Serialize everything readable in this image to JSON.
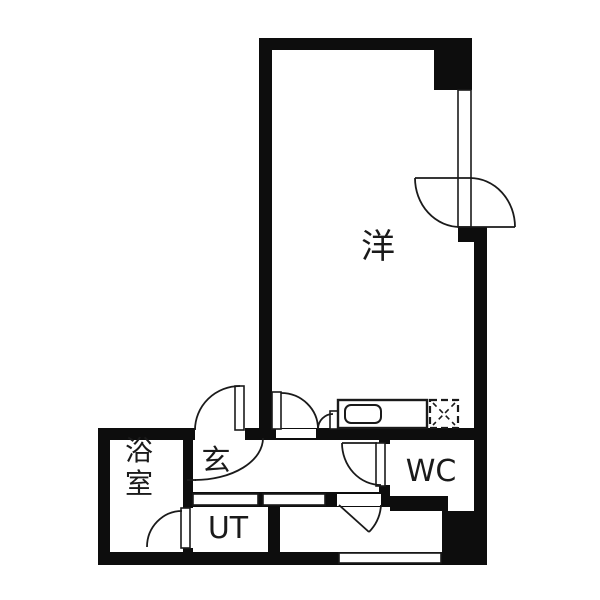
{
  "meta": {
    "type": "japanese-apartment-floorplan",
    "canvas_width": 600,
    "canvas_height": 600,
    "background_color": "#ffffff",
    "wall_color": "#0d0d0d",
    "line_color": "#1a1a1a"
  },
  "rooms": [
    {
      "id": "western-room",
      "label": "洋",
      "x": 378,
      "y": 258,
      "font": 34,
      "vertical": false
    },
    {
      "id": "entrance",
      "label": "玄",
      "x": 216,
      "y": 470,
      "font": 29,
      "vertical": false
    },
    {
      "id": "bathroom",
      "label": "浴室",
      "x": 139,
      "y": 460,
      "font": 28,
      "vertical": true
    },
    {
      "id": "utility",
      "label": "UT",
      "x": 228,
      "y": 538,
      "font": 30,
      "vertical": false
    },
    {
      "id": "toilet",
      "label": "WC",
      "x": 431,
      "y": 481,
      "font": 30,
      "vertical": false
    }
  ],
  "walls": [
    {
      "name": "top-wall",
      "x": 259,
      "y": 38,
      "w": 213,
      "h": 12
    },
    {
      "name": "left-wall-main-room",
      "x": 259,
      "y": 38,
      "w": 13,
      "h": 402
    },
    {
      "name": "top-right-block",
      "x": 434,
      "y": 38,
      "w": 38,
      "h": 52
    },
    {
      "name": "right-step-block",
      "x": 458,
      "y": 227,
      "w": 29,
      "h": 15
    },
    {
      "name": "right-wall",
      "x": 474,
      "y": 242,
      "w": 13,
      "h": 196
    },
    {
      "name": "kitchen-corridor-band",
      "x": 245,
      "y": 428,
      "w": 242,
      "h": 12
    },
    {
      "name": "entry-top-band",
      "x": 98,
      "y": 428,
      "w": 97,
      "h": 12
    },
    {
      "name": "left-outer-wall",
      "x": 98,
      "y": 428,
      "w": 12,
      "h": 137
    },
    {
      "name": "bottom-wall",
      "x": 98,
      "y": 552,
      "w": 345,
      "h": 13
    },
    {
      "name": "bath-right-wall",
      "x": 183,
      "y": 438,
      "w": 10,
      "h": 70
    },
    {
      "name": "bath-right-wall-low",
      "x": 183,
      "y": 548,
      "w": 10,
      "h": 8
    },
    {
      "name": "corridor-bottom-band",
      "x": 192,
      "y": 492,
      "w": 198,
      "h": 15
    },
    {
      "name": "wc-hinge-wall-top",
      "x": 379,
      "y": 430,
      "w": 11,
      "h": 14
    },
    {
      "name": "wc-hinge-wall-bottom",
      "x": 379,
      "y": 485,
      "w": 11,
      "h": 11
    },
    {
      "name": "wc-right-wall",
      "x": 474,
      "y": 438,
      "w": 13,
      "h": 73
    },
    {
      "name": "ut-right-wall",
      "x": 268,
      "y": 507,
      "w": 12,
      "h": 45
    },
    {
      "name": "bottom-right-block",
      "x": 442,
      "y": 511,
      "w": 45,
      "h": 54
    }
  ],
  "white_areas": [
    {
      "name": "wc-interior",
      "x": 390,
      "y": 440,
      "w": 84,
      "h": 71,
      "stroke": false
    }
  ],
  "inner_walls_after": [
    {
      "name": "wc-bottom-wall",
      "x": 390,
      "y": 496,
      "w": 58,
      "h": 15
    }
  ],
  "openings": [
    {
      "name": "entrance-door-opening",
      "x": 195,
      "y": 429,
      "w": 49,
      "h": 9,
      "stroke": false
    },
    {
      "name": "corridor-door-opening",
      "x": 276,
      "y": 429,
      "w": 40,
      "h": 9,
      "stroke": false
    },
    {
      "name": "ut-partition-segment",
      "x": 193,
      "y": 494,
      "w": 65,
      "h": 11,
      "stroke": true
    },
    {
      "name": "hall-partition-segment",
      "x": 263,
      "y": 494,
      "w": 62,
      "h": 11,
      "stroke": true
    },
    {
      "name": "bottom-room-door-opening",
      "x": 337,
      "y": 494,
      "w": 44,
      "h": 12,
      "stroke": false
    },
    {
      "name": "bottom-window",
      "x": 339,
      "y": 553,
      "w": 102,
      "h": 10,
      "stroke": true
    },
    {
      "name": "right-window",
      "x": 458,
      "y": 90,
      "w": 13,
      "h": 137,
      "stroke": true
    },
    {
      "name": "counter-end-panel",
      "x": 330,
      "y": 411,
      "w": 9,
      "h": 18,
      "stroke": true
    }
  ],
  "door_leaves": [
    {
      "name": "entrance-door-leaf",
      "x": 235,
      "y": 386,
      "w": 9,
      "h": 44
    },
    {
      "name": "corridor-door-leaf",
      "x": 272,
      "y": 392,
      "w": 9,
      "h": 37
    },
    {
      "name": "wc-door-leaf",
      "x": 376,
      "y": 443,
      "w": 9,
      "h": 43
    },
    {
      "name": "bath-door-leaf",
      "x": 181,
      "y": 508,
      "w": 9,
      "h": 40
    }
  ],
  "arcs": [
    {
      "name": "entrance-door-arc",
      "d": "M 195 430 A 45 44 0 0 1 240 386"
    },
    {
      "name": "genkan-step-arc",
      "d": "M 263 438 A 68 42 0 0 1 195 480"
    },
    {
      "name": "corridor-door-arc",
      "d": "M 281 393 A 37 36 0 0 1 318 429"
    },
    {
      "name": "counter-end-arc",
      "d": "M 318 429 A 15 15 0 0 1 333 414"
    },
    {
      "name": "wc-door-arc",
      "d": "M 342 443 A 39 42 0 0 0 381 485"
    },
    {
      "name": "bath-door-arc",
      "d": "M 182 511 A 35 36 0 0 0 147 547"
    },
    {
      "name": "bottom-room-door-arc",
      "d": "M 381 505 A 42 42 0 0 1 369 532"
    },
    {
      "name": "balcony-door-arc-left",
      "d": "M 415 178 A 45 49 0 0 0 460 227"
    },
    {
      "name": "balcony-door-arc-right",
      "d": "M 470 178 A 45 49 0 0 1 515 227"
    }
  ],
  "lines": [
    {
      "name": "genkan-arc-tick",
      "x1": 187,
      "y1": 480,
      "x2": 196,
      "y2": 480
    },
    {
      "name": "wc-door-frame-line",
      "x1": 342,
      "y1": 443,
      "x2": 377,
      "y2": 443
    },
    {
      "name": "bottom-room-door-leaf",
      "x1": 339,
      "y1": 505,
      "x2": 369,
      "y2": 532
    },
    {
      "name": "balcony-door-top-line",
      "x1": 415,
      "y1": 178,
      "x2": 472,
      "y2": 178
    },
    {
      "name": "balcony-door-bottom-line",
      "x1": 458,
      "y1": 227,
      "x2": 515,
      "y2": 227
    }
  ],
  "fixtures": {
    "kitchen_counter": {
      "x": 338,
      "y": 400,
      "w": 89,
      "h": 28
    },
    "kitchen_sink": {
      "x": 345,
      "y": 405,
      "w": 36,
      "h": 18,
      "rx": 6
    },
    "stove_dashed_box": {
      "x": 430,
      "y": 400,
      "w": 28,
      "h": 28
    }
  }
}
